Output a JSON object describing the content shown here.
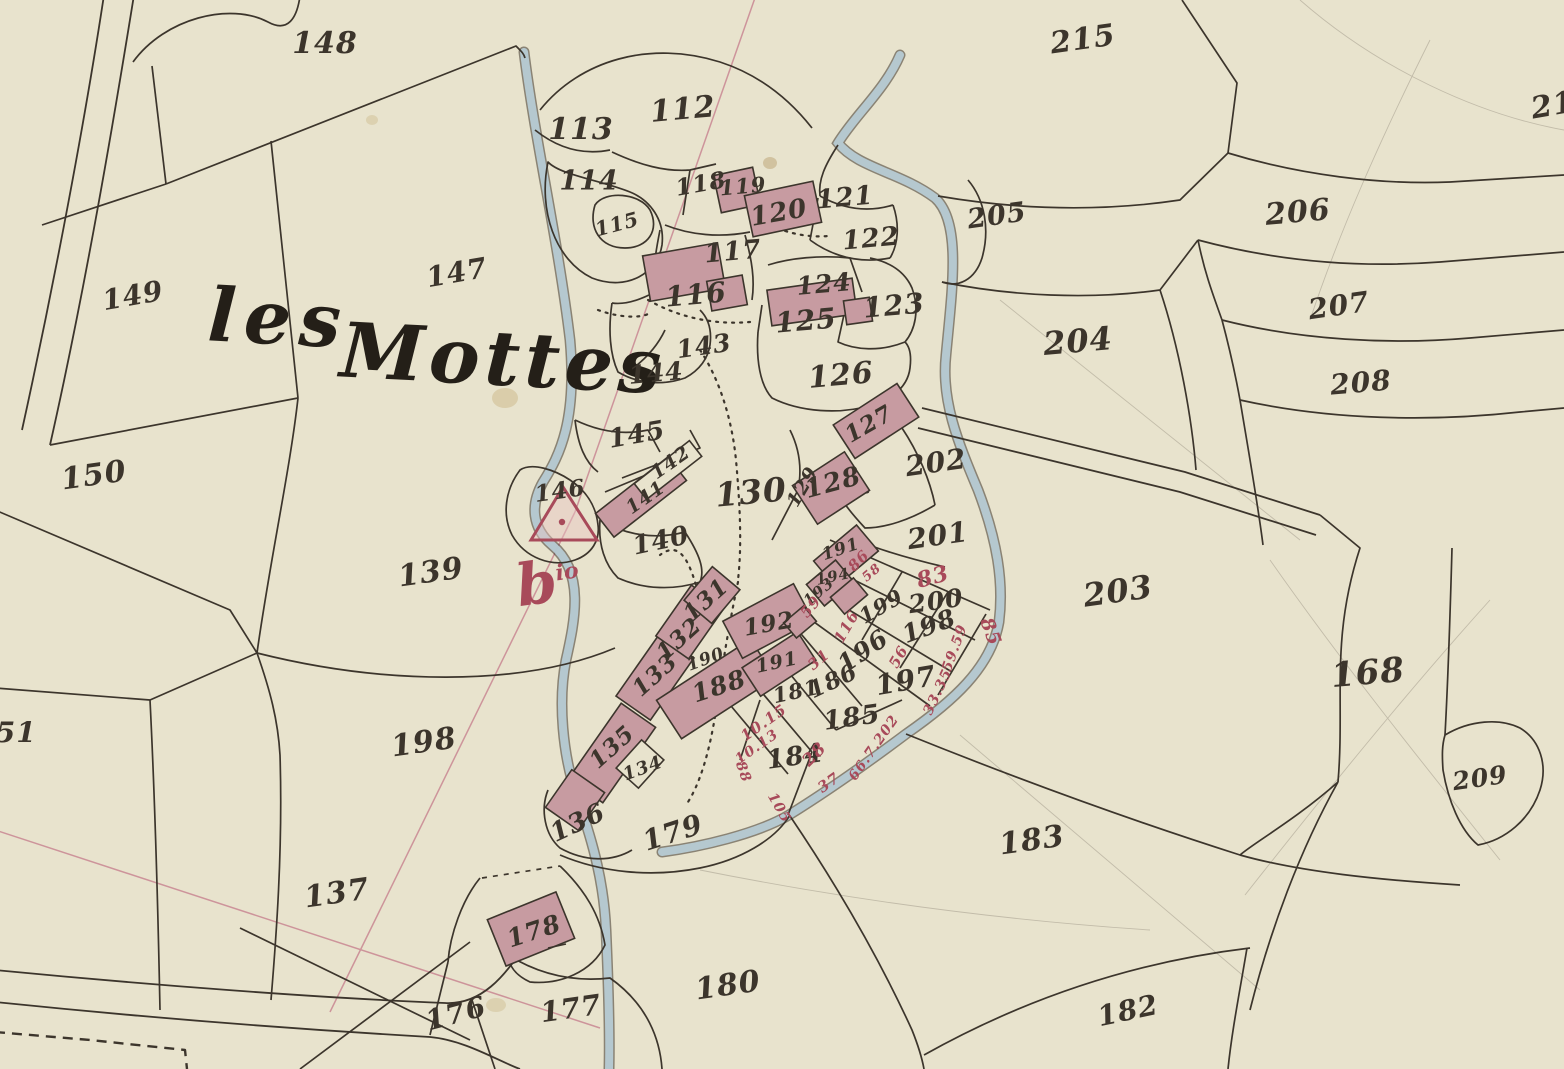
{
  "map": {
    "title": {
      "word1": "les",
      "word2": "Mottes"
    },
    "hamlet_mark": {
      "letter": "b",
      "sup": "io"
    },
    "marker": {
      "shape": "triangle-with-dot",
      "parcel": "146"
    },
    "palette": {
      "paper": "#e8e3cd",
      "ink": "#3c352c",
      "building": "#c79ba1",
      "stream": "#b7cbd4",
      "red": "#a84a5a",
      "survey": "#c47a8a",
      "pencil": "#8a8274"
    },
    "parcel_labels": [
      {
        "t": "148",
        "x": 325,
        "y": 44,
        "s": 30,
        "r": 0
      },
      {
        "t": "112",
        "x": 683,
        "y": 110,
        "s": 30,
        "r": -5
      },
      {
        "t": "113",
        "x": 581,
        "y": 130,
        "s": 30,
        "r": 0
      },
      {
        "t": "114",
        "x": 589,
        "y": 181,
        "s": 27,
        "r": 0
      },
      {
        "t": "115",
        "x": 617,
        "y": 224,
        "s": 20,
        "r": -15
      },
      {
        "t": "118",
        "x": 701,
        "y": 184,
        "s": 23,
        "r": -10
      },
      {
        "t": "119",
        "x": 743,
        "y": 186,
        "s": 21,
        "r": -5
      },
      {
        "t": "120",
        "x": 779,
        "y": 213,
        "s": 26,
        "r": -10
      },
      {
        "t": "121",
        "x": 845,
        "y": 198,
        "s": 26,
        "r": -5
      },
      {
        "t": "122",
        "x": 871,
        "y": 239,
        "s": 26,
        "r": -5
      },
      {
        "t": "117",
        "x": 733,
        "y": 252,
        "s": 26,
        "r": -5
      },
      {
        "t": "116",
        "x": 696,
        "y": 295,
        "s": 28,
        "r": -5
      },
      {
        "t": "124",
        "x": 824,
        "y": 284,
        "s": 25,
        "r": -5
      },
      {
        "t": "125",
        "x": 806,
        "y": 321,
        "s": 28,
        "r": -5
      },
      {
        "t": "123",
        "x": 894,
        "y": 306,
        "s": 28,
        "r": -5
      },
      {
        "t": "215",
        "x": 1083,
        "y": 40,
        "s": 30,
        "r": -8
      },
      {
        "t": "205",
        "x": 997,
        "y": 216,
        "s": 27,
        "r": -8
      },
      {
        "t": "206",
        "x": 1298,
        "y": 213,
        "s": 30,
        "r": -5
      },
      {
        "t": "207",
        "x": 1339,
        "y": 306,
        "s": 28,
        "r": -8
      },
      {
        "t": "208",
        "x": 1361,
        "y": 383,
        "s": 28,
        "r": -5
      },
      {
        "t": "204",
        "x": 1078,
        "y": 341,
        "s": 32,
        "r": -5
      },
      {
        "t": "21",
        "x": 1553,
        "y": 106,
        "s": 30,
        "r": -10
      },
      {
        "t": "147",
        "x": 457,
        "y": 273,
        "s": 28,
        "r": -10
      },
      {
        "t": "149",
        "x": 133,
        "y": 296,
        "s": 28,
        "r": -10
      },
      {
        "t": "143",
        "x": 704,
        "y": 346,
        "s": 25,
        "r": -8
      },
      {
        "t": "144",
        "x": 656,
        "y": 373,
        "s": 25,
        "r": -5
      },
      {
        "t": "126",
        "x": 841,
        "y": 376,
        "s": 30,
        "r": -5
      },
      {
        "t": "127",
        "x": 869,
        "y": 424,
        "s": 23,
        "r": -30
      },
      {
        "t": "145",
        "x": 637,
        "y": 435,
        "s": 26,
        "r": -10
      },
      {
        "t": "142",
        "x": 671,
        "y": 463,
        "s": 19,
        "r": -35
      },
      {
        "t": "141",
        "x": 646,
        "y": 498,
        "s": 19,
        "r": -35
      },
      {
        "t": "146",
        "x": 560,
        "y": 491,
        "s": 23,
        "r": -8
      },
      {
        "t": "140",
        "x": 661,
        "y": 541,
        "s": 26,
        "r": -12
      },
      {
        "t": "130",
        "x": 751,
        "y": 492,
        "s": 33,
        "r": -5
      },
      {
        "t": "129",
        "x": 803,
        "y": 487,
        "s": 19,
        "r": -60
      },
      {
        "t": "128",
        "x": 833,
        "y": 483,
        "s": 26,
        "r": -15
      },
      {
        "t": "202",
        "x": 936,
        "y": 463,
        "s": 28,
        "r": -8
      },
      {
        "t": "201",
        "x": 938,
        "y": 536,
        "s": 28,
        "r": -8
      },
      {
        "t": "150",
        "x": 94,
        "y": 476,
        "s": 30,
        "r": -8
      },
      {
        "t": "139",
        "x": 431,
        "y": 573,
        "s": 30,
        "r": -8
      },
      {
        "t": "203",
        "x": 1118,
        "y": 591,
        "s": 32,
        "r": -8
      },
      {
        "t": "168",
        "x": 1368,
        "y": 673,
        "s": 34,
        "r": -5
      },
      {
        "t": "209",
        "x": 1480,
        "y": 778,
        "s": 25,
        "r": -8
      },
      {
        "t": "131",
        "x": 706,
        "y": 600,
        "s": 23,
        "r": -42
      },
      {
        "t": "132",
        "x": 679,
        "y": 639,
        "s": 23,
        "r": -42
      },
      {
        "t": "133",
        "x": 655,
        "y": 675,
        "s": 23,
        "r": -42
      },
      {
        "t": "135",
        "x": 612,
        "y": 747,
        "s": 23,
        "r": -42
      },
      {
        "t": "134",
        "x": 643,
        "y": 769,
        "s": 18,
        "r": -20
      },
      {
        "t": "136",
        "x": 578,
        "y": 823,
        "s": 26,
        "r": -25
      },
      {
        "t": "198",
        "x": 424,
        "y": 743,
        "s": 30,
        "r": -8
      },
      {
        "t": "151",
        "x": 6,
        "y": 733,
        "s": 28,
        "r": 0
      },
      {
        "t": "137",
        "x": 337,
        "y": 894,
        "s": 30,
        "r": -8
      },
      {
        "t": "179",
        "x": 673,
        "y": 833,
        "s": 28,
        "r": -18
      },
      {
        "t": "178",
        "x": 534,
        "y": 931,
        "s": 25,
        "r": -18
      },
      {
        "t": "176",
        "x": 456,
        "y": 1014,
        "s": 28,
        "r": -15
      },
      {
        "t": "177",
        "x": 571,
        "y": 1009,
        "s": 28,
        "r": -8
      },
      {
        "t": "180",
        "x": 728,
        "y": 986,
        "s": 30,
        "r": -8
      },
      {
        "t": "183",
        "x": 1032,
        "y": 841,
        "s": 30,
        "r": -8
      },
      {
        "t": "182",
        "x": 1128,
        "y": 1011,
        "s": 28,
        "r": -12
      },
      {
        "t": "184",
        "x": 795,
        "y": 757,
        "s": 26,
        "r": -8
      },
      {
        "t": "185",
        "x": 852,
        "y": 718,
        "s": 26,
        "r": -8
      },
      {
        "t": "181",
        "x": 796,
        "y": 691,
        "s": 21,
        "r": -12
      },
      {
        "t": "186",
        "x": 833,
        "y": 681,
        "s": 23,
        "r": -25
      },
      {
        "t": "196",
        "x": 863,
        "y": 651,
        "s": 25,
        "r": -35
      },
      {
        "t": "197",
        "x": 906,
        "y": 681,
        "s": 28,
        "r": -10
      },
      {
        "t": "198",
        "x": 929,
        "y": 626,
        "s": 25,
        "r": -20
      },
      {
        "t": "199",
        "x": 881,
        "y": 606,
        "s": 21,
        "r": -30
      },
      {
        "t": "200",
        "x": 936,
        "y": 601,
        "s": 25,
        "r": -8
      },
      {
        "t": "188",
        "x": 719,
        "y": 686,
        "s": 25,
        "r": -18
      },
      {
        "t": "190",
        "x": 706,
        "y": 660,
        "s": 17,
        "r": -20
      },
      {
        "t": "191",
        "x": 777,
        "y": 663,
        "s": 19,
        "r": -12
      },
      {
        "t": "192",
        "x": 769,
        "y": 624,
        "s": 23,
        "r": -10
      },
      {
        "t": "191",
        "x": 841,
        "y": 550,
        "s": 17,
        "r": -18
      },
      {
        "t": "194",
        "x": 833,
        "y": 577,
        "s": 15,
        "r": -12
      },
      {
        "t": "193",
        "x": 819,
        "y": 592,
        "s": 15,
        "r": -40
      }
    ],
    "red_annotations": [
      {
        "t": "83",
        "x": 933,
        "y": 577,
        "s": 22,
        "r": -15
      },
      {
        "t": "85",
        "x": 990,
        "y": 632,
        "s": 19,
        "r": 70
      },
      {
        "t": "86",
        "x": 859,
        "y": 561,
        "s": 15,
        "r": -45
      },
      {
        "t": "58",
        "x": 872,
        "y": 573,
        "s": 13,
        "r": -40
      },
      {
        "t": "59",
        "x": 811,
        "y": 607,
        "s": 15,
        "r": -50
      },
      {
        "t": "116",
        "x": 847,
        "y": 627,
        "s": 15,
        "r": -60
      },
      {
        "t": "56",
        "x": 899,
        "y": 657,
        "s": 15,
        "r": -60
      },
      {
        "t": "59.59",
        "x": 955,
        "y": 648,
        "s": 14,
        "r": -70
      },
      {
        "t": "33.35",
        "x": 938,
        "y": 692,
        "s": 14,
        "r": -65
      },
      {
        "t": "31",
        "x": 819,
        "y": 660,
        "s": 15,
        "r": -40
      },
      {
        "t": "10.15",
        "x": 764,
        "y": 723,
        "s": 15,
        "r": -35
      },
      {
        "t": "10.13",
        "x": 757,
        "y": 747,
        "s": 14,
        "r": -35
      },
      {
        "t": "28",
        "x": 815,
        "y": 755,
        "s": 17,
        "r": -45
      },
      {
        "t": "37",
        "x": 829,
        "y": 783,
        "s": 15,
        "r": -35
      },
      {
        "t": "105",
        "x": 779,
        "y": 808,
        "s": 14,
        "r": 60
      },
      {
        "t": "66.7.202",
        "x": 874,
        "y": 748,
        "s": 14,
        "r": -55
      },
      {
        "t": "88",
        "x": 743,
        "y": 772,
        "s": 14,
        "r": 70
      }
    ]
  }
}
